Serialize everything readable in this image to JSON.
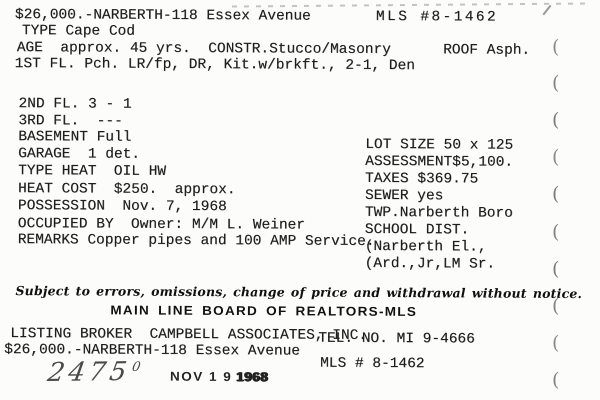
{
  "card": {
    "header": {
      "price_address": "$26,000.-NARBERTH-118 Essex Avenue",
      "mls_number": "MLS #8-1462",
      "type_line": "TYPE Cape Cod",
      "age_constr_roof_line": "AGE  approx. 45 yrs.  CONSTR.Stucco/Masonry      ROOF Asph.",
      "first_floor_line": "1ST FL. Pch. LR/fp, DR, Kit.w/brkft., 2-1, Den"
    },
    "left_details": [
      "2ND FL. 3 - 1",
      "3RD FL.  ---",
      "BASEMENT Full",
      "GARAGE  1 det.",
      "TYPE HEAT  OIL HW",
      "HEAT COST  $250.  approx.",
      "POSSESSION  Nov. 7, 1968",
      "OCCUPIED BY  Owner: M/M L. Weiner",
      "REMARKS Copper pipes and 100 AMP Service."
    ],
    "right_details": [
      "LOT SIZE 50 x 125",
      "ASSESSMENT$5,100.",
      "TAXES $369.75",
      "SEWER yes",
      "TWP.Narberth Boro",
      "SCHOOL DIST.",
      "(Narberth El.,",
      "(Ard.,Jr,LM Sr."
    ],
    "footer": {
      "disclaimer": "Subject to errors, omissions, change of price and withdrawal without notice.",
      "organization": "MAIN LINE BOARD OF REALTORS-MLS",
      "listing_broker": "LISTING BROKER  CAMPBELL ASSOCIATES, INC.",
      "telephone": "TEL. NO. MI 9-4666",
      "price_address_repeat": "$26,000.-NARBERTH-118 Essex Avenue",
      "mls_number_repeat": "MLS # 8-1462"
    },
    "annotations": {
      "handwritten_number": "2475",
      "handwritten_superscript": "0",
      "stamp_date": "NOV 1 9",
      "stamp_year": "1968"
    },
    "edge_mark_glyph": "(",
    "colors": {
      "ink": "#1d1d1d",
      "paper": "#fcfcfa",
      "stamp_ink": "#242424",
      "pen_ink": "#4a4a4a"
    }
  }
}
